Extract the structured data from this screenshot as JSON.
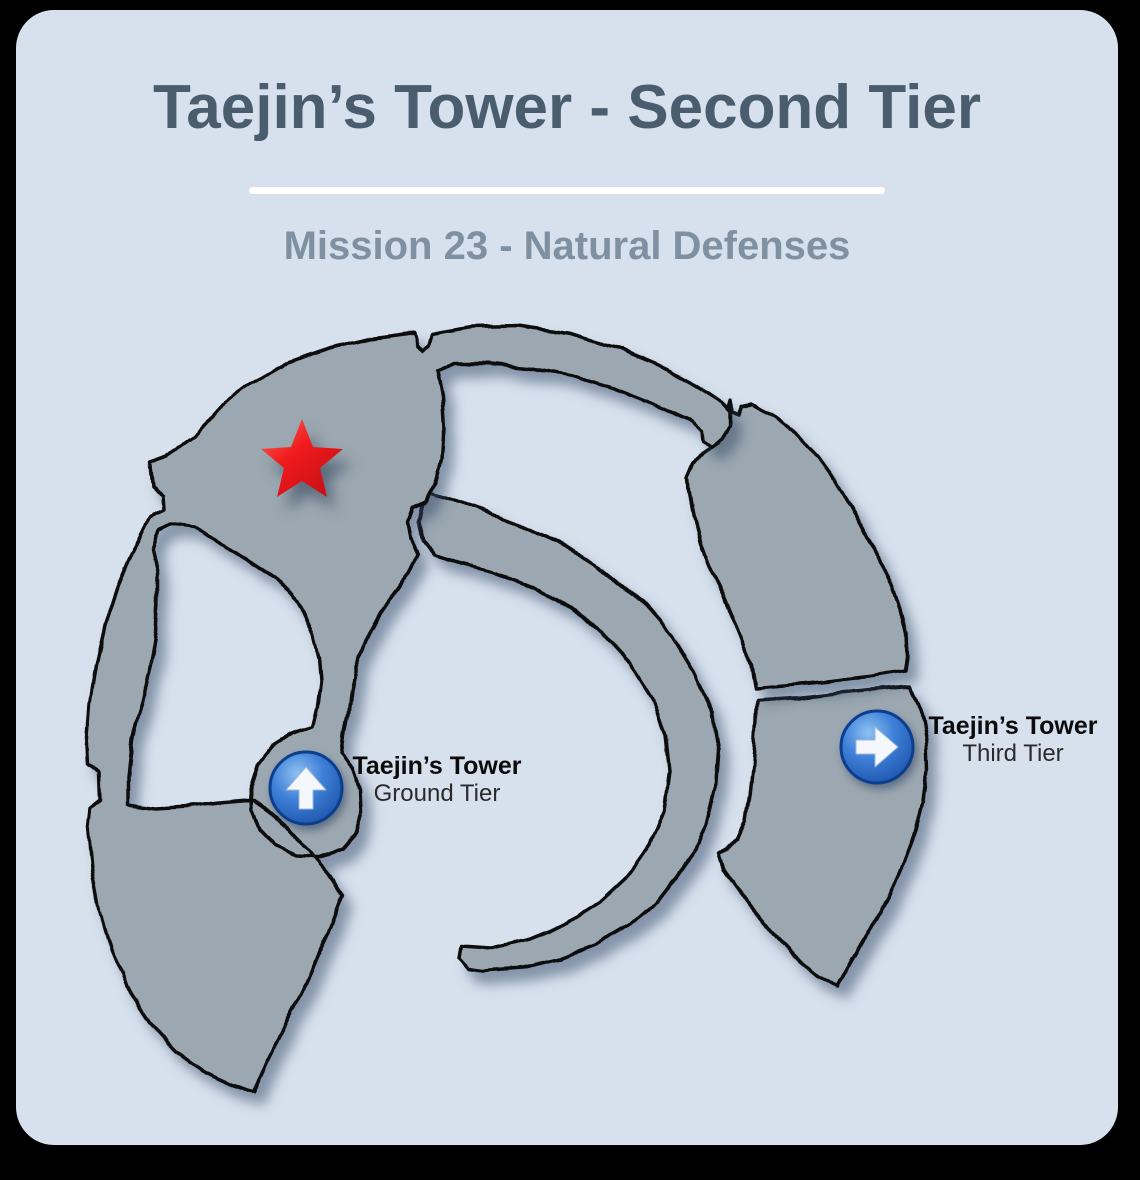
{
  "header": {
    "title": "Taejin’s Tower - Second Tier",
    "subtitle": "Mission 23 - Natural Defenses"
  },
  "map": {
    "mission_marker": "red-star",
    "markers": [
      {
        "name": "Taejin’s Tower",
        "tier": "Ground Tier",
        "direction": "up"
      },
      {
        "name": "Taejin’s Tower",
        "tier": "Third Tier",
        "direction": "right"
      }
    ]
  },
  "colors": {
    "frame": "#000000",
    "card_background": "#d7e1ed",
    "map_fill": "#9ba8b1",
    "map_outline": "#0c0c0c",
    "title_text": "#4a5d6e",
    "subtitle_text": "#7e90a1",
    "label_text": "#111111",
    "marker_blue": "#2f74d0",
    "star_red": "#ee1c24",
    "divider": "#ffffff"
  }
}
